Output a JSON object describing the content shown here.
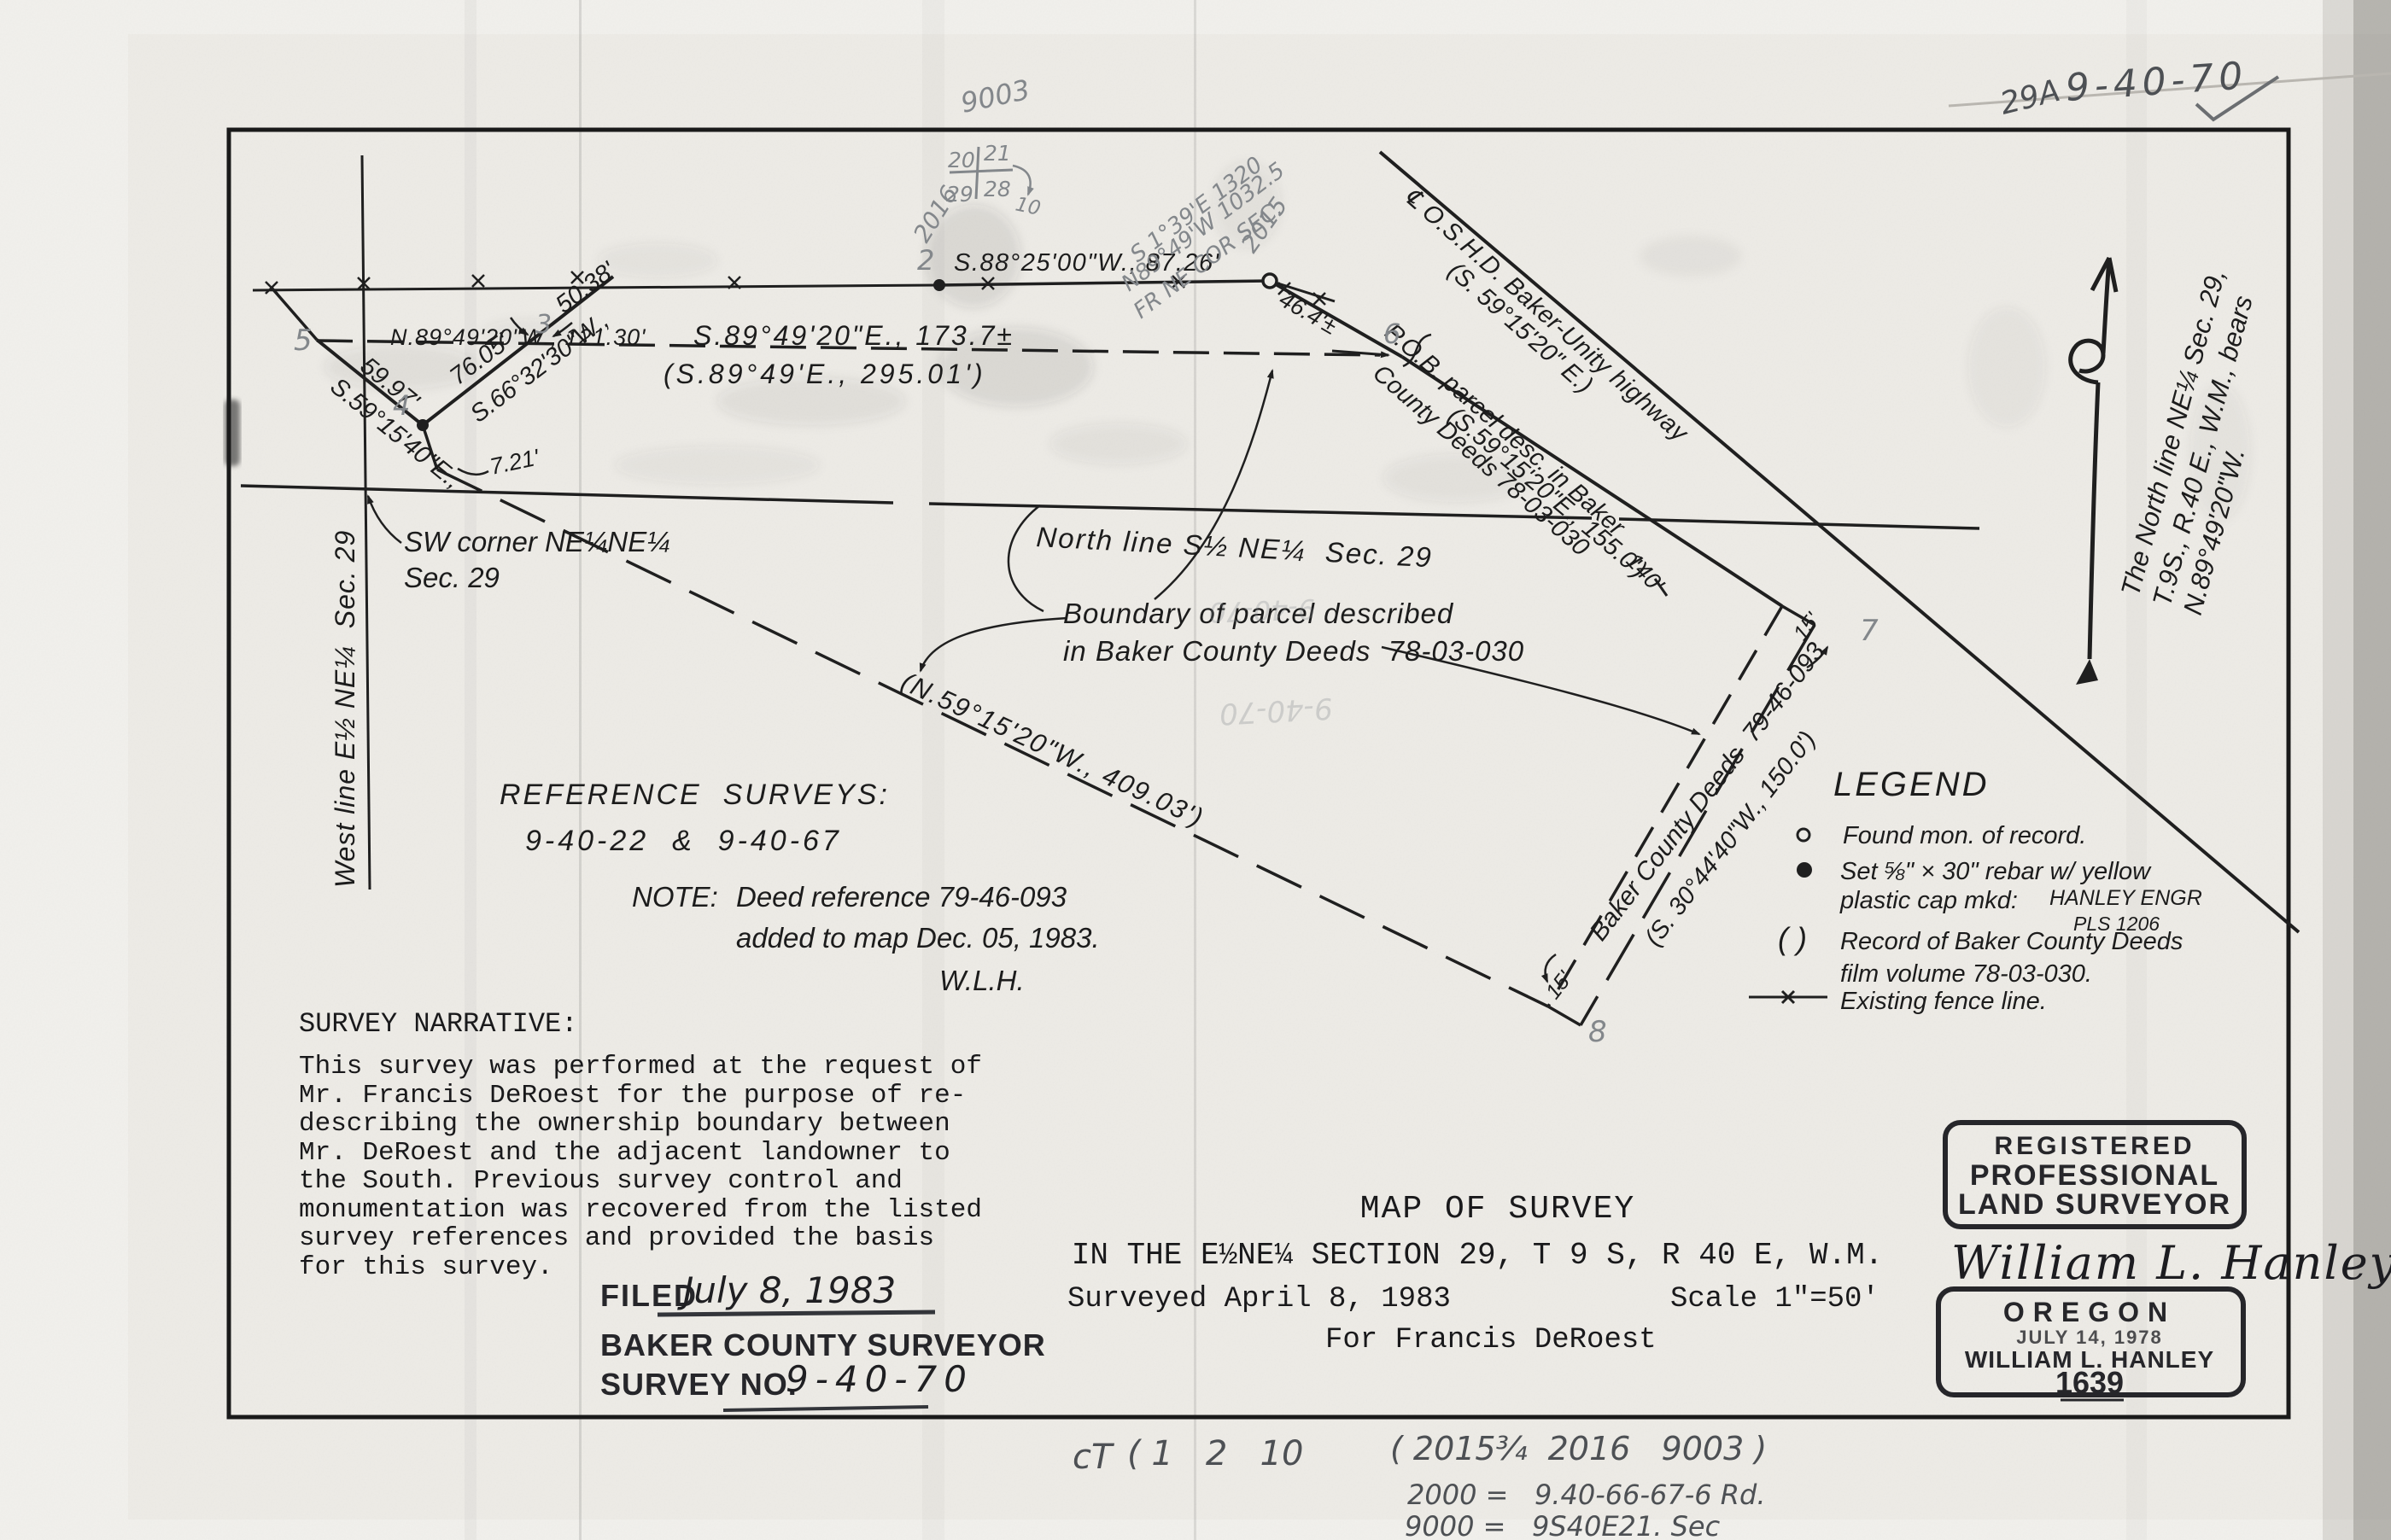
{
  "pencil_top": {
    "sheet_page": "29A",
    "sheet_ref": "9-40-70"
  },
  "corner_diagram": {
    "point_id": "9003",
    "nw": "20",
    "ne": "21",
    "sw": "29",
    "se": "28",
    "below": "10"
  },
  "pencil_map": {
    "v2": "2",
    "v3": "3",
    "v4": "4",
    "v5": "5",
    "v6": "6",
    "v7": "7",
    "v8": "8",
    "n2016": "2016",
    "n2015": "2015",
    "calc1": "S 1°39'E 1320",
    "calc2": "N89°49'W 1032.5",
    "calc3": "FR NE COR SEC.",
    "ghost1": "9-40-70",
    "ghost2": "9-40-70"
  },
  "bearings": {
    "fence_left": "N.89°49'20\"W., 121.30'",
    "seg_5038": "50.38'",
    "deed_right": "S.89°49'20\"E., 173.7±",
    "deed_right_rec": "(S.89°49'E., 295.01')",
    "seg_s88": "S.88°25'00\"W., 87.26'",
    "seg_7605": "76.05'",
    "seg_s66": "S.66°32'30\"W.,",
    "seg_5997": "59.97'",
    "seg_s59": "S.59°15'40\"E.,",
    "seg_721": "7.21'",
    "seg_464": "46.4'±",
    "sw_rec": "(N.59°15'20\"W., 409.03')",
    "ne_rec": "(S.59°15'20\"E., 155.0')",
    "d140": "140'",
    "corridor_rec": "(S. 30°44'40\"W., 150.0')",
    "d15": "15'"
  },
  "labels": {
    "highway": "℄ O.S.H.D. Baker-Unity highway",
    "highway_bearing": "(S. 59°15'20\" E.)",
    "pob1": "P.O.B. parcel desc. in Baker",
    "pob2": "County Deeds 78-03-030",
    "north_line": "North line S½ NE¼  Sec. 29",
    "sw_corner1": "SW corner NE¼NE¼",
    "sw_corner2": "Sec. 29",
    "west_line": "West line E½ NE¼  Sec. 29",
    "boundary1": "Boundary of parcel described",
    "boundary2": "in Baker County Deeds  78-03-030",
    "corridor": "Baker County Deeds  79-46-093",
    "north_note1": "The North line NE¼ Sec. 29,",
    "north_note2": "T.9S., R.40 E., W.M., bears",
    "north_note3": "N.89°49'20\"W."
  },
  "reference": {
    "line1": "REFERENCE  SURVEYS:",
    "line2": "9-40-22  &  9-40-67"
  },
  "note": {
    "label": "NOTE:",
    "line1": "Deed reference 79-46-093",
    "line2": "added to map Dec. 05, 1983.",
    "initials": "W.L.H."
  },
  "narrative": {
    "heading": "SURVEY NARRATIVE:",
    "lines": [
      "This survey was performed at the request of",
      "Mr. Francis DeRoest for the purpose of re-",
      "describing the ownership boundary between",
      "Mr. DeRoest and the adjacent landowner to",
      "the South. Previous survey control and",
      "monumentation was recovered from the listed",
      "survey references and provided the basis",
      "for this survey."
    ]
  },
  "filed": {
    "label": "FILED",
    "date": "July 8, 1983",
    "office": "BAKER COUNTY SURVEYOR",
    "survey_no_label": "SURVEY NO.",
    "survey_no": "9-40-70"
  },
  "title_block": {
    "title": "MAP OF SURVEY",
    "location": "IN THE E½NE¼ SECTION 29, T 9 S, R 40 E, W.M.",
    "surveyed": "Surveyed April 8, 1983",
    "scale": "Scale 1\"=50'",
    "client": "For Francis DeRoest"
  },
  "legend": {
    "heading": "LEGEND",
    "found": "Found mon. of record.",
    "set1": "Set ⅝\" × 30\" rebar w/ yellow",
    "set2": "plastic cap mkd:",
    "set2b": "HANLEY ENGR",
    "set2c": "PLS 1206",
    "record_sym": "( )",
    "record1": "Record of Baker County Deeds",
    "record2": "film volume 78-03-030.",
    "fence": "Existing fence line."
  },
  "stamp": {
    "l1": "REGISTERED",
    "l2": "PROFESSIONAL",
    "l3": "LAND SURVEYOR",
    "signature": "William L. Hanley",
    "state": "OREGON",
    "date": "JULY 14, 1978",
    "name": "WILLIAM L. HANLEY",
    "number": "1639"
  },
  "pencil_bottom": {
    "l1a": "cT",
    "l1b": "( 1   2   10",
    "l1c": "( 2015¾  2016   9003 )",
    "l2": "2000 =   9.40-66-67-6 Rd.",
    "l3": "9000 =   9S40E21. Sec"
  }
}
